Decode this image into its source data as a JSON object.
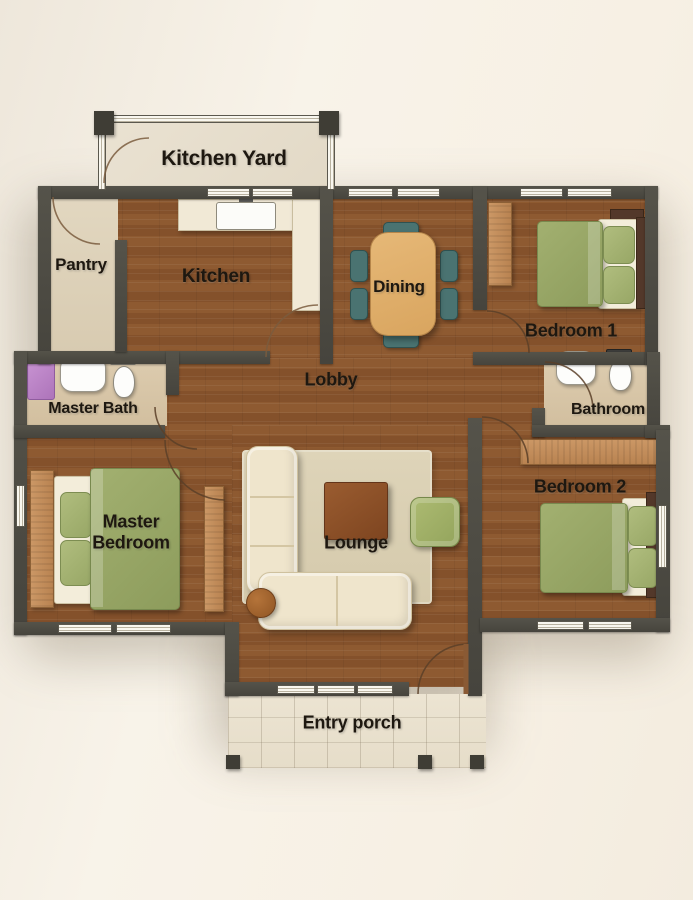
{
  "plan_title": "3-bedroom house floor plan (top view)",
  "rooms": {
    "kitchen_yard": {
      "label": "Kitchen Yard"
    },
    "pantry": {
      "label": "Pantry"
    },
    "kitchen": {
      "label": "Kitchen"
    },
    "dining": {
      "label": "Dining"
    },
    "bedroom1": {
      "label": "Bedroom 1"
    },
    "lobby": {
      "label": "Lobby"
    },
    "master_bath": {
      "label": "Master Bath"
    },
    "bathroom": {
      "label": "Bathroom"
    },
    "master_bedroom": {
      "label": "Master Bedroom"
    },
    "lounge": {
      "label": "Lounge"
    },
    "bedroom2": {
      "label": "Bedroom 2"
    },
    "entry_porch": {
      "label": "Entry porch"
    }
  },
  "furniture": [
    "kitchen-counter",
    "kitchen-sink",
    "dining-table",
    "dining-chairs",
    "bed",
    "pillows",
    "wardrobe",
    "closet",
    "rug",
    "l-shaped-sofa",
    "coffee-table",
    "armchair",
    "side-table",
    "shower",
    "bathroom-sink",
    "toilet"
  ],
  "colors": {
    "background": "#f6f0e6",
    "wall": "#4c4a42",
    "wood_floor": "#8a5630",
    "pantry_floor": "#dcd0b8",
    "bath_floor": "#d7c5a6",
    "porch_tile": "#e9e1cf",
    "bed_green": "#98a765",
    "chair_teal": "#4a7371",
    "sofa_cream": "#efe5cc",
    "table_tan": "#e0ae6c",
    "coffee_table_brown": "#8a4f28",
    "shower_purple": "#bc85c8"
  }
}
